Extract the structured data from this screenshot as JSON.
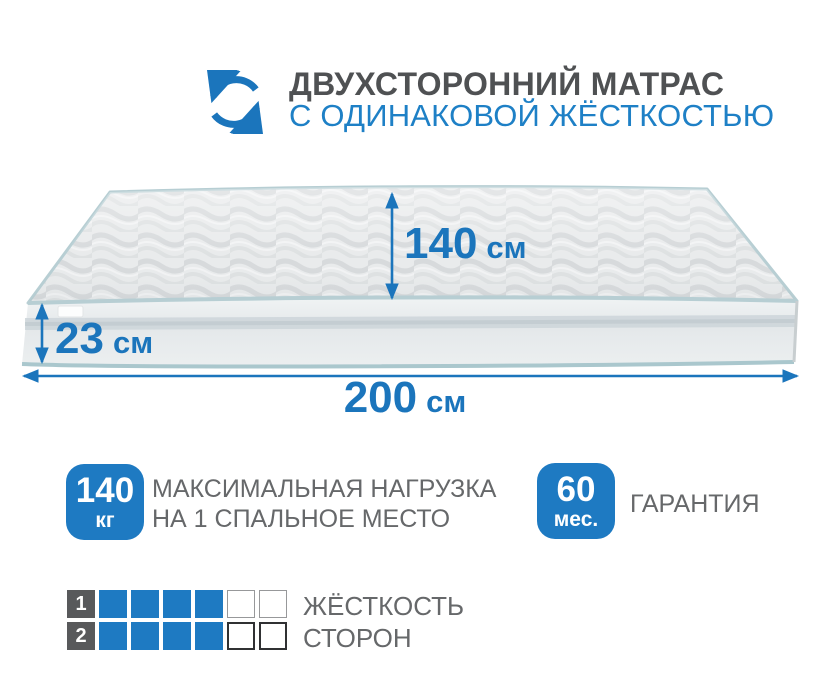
{
  "header": {
    "icon": "flip-arrows-icon",
    "title_line1": "ДВУХСТОРОННИЙ МАТРАС",
    "title_line2": "С ОДИНАКОВОЙ ЖЁСТКОСТЬЮ"
  },
  "mattress": {
    "dimensions": {
      "depth": {
        "value": "140",
        "unit": "см"
      },
      "height": {
        "value": "23",
        "unit": "см"
      },
      "length": {
        "value": "200",
        "unit": "см"
      }
    }
  },
  "features": [
    {
      "badge_value": "140",
      "badge_unit": "кг",
      "label_line1": "МАКСИМАЛЬНАЯ НАГРУЗКА",
      "label_line2": "НА 1 СПАЛЬНОЕ МЕСТО"
    },
    {
      "badge_value": "60",
      "badge_unit": "мес.",
      "label_line1": "ГАРАНТИЯ"
    }
  ],
  "hardness": {
    "rows": [
      {
        "num": "1",
        "filled": 4,
        "empty": 2
      },
      {
        "num": "2",
        "filled": 4,
        "empty": 2
      }
    ],
    "scale_max": 6,
    "label_line1": "ЖЁСТКОСТЬ",
    "label_line2": "СТОРОН"
  },
  "colors": {
    "accent_blue": "#1b75bc",
    "badge_blue": "#1e7ac2",
    "title_gray": "#4f5153",
    "text_gray": "#66686a",
    "square_gray": "#58595b",
    "piping_teal": "#b7ced3"
  }
}
